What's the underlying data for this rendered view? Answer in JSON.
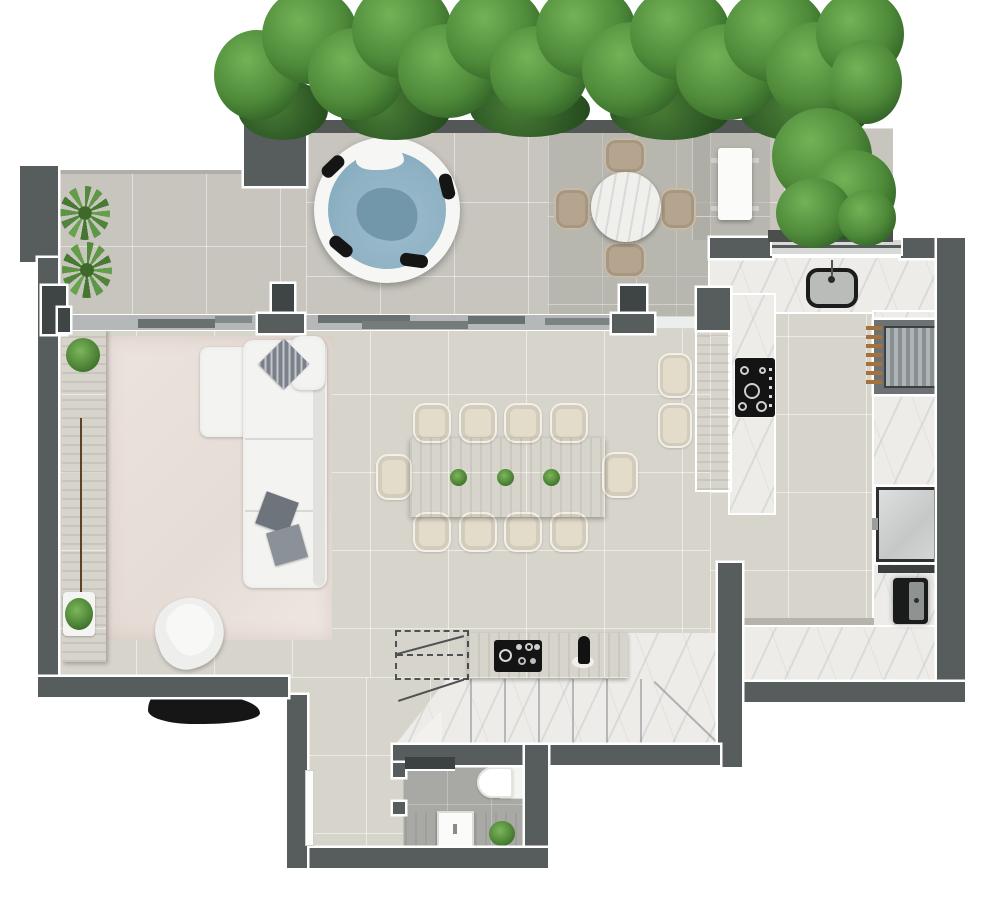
{
  "meta": {
    "title": "Penthouse floor plan - top-down 3D render",
    "view": "top-down architectural rendering",
    "visible_text": "none"
  },
  "rooms": [
    {
      "name": "terrace",
      "features": [
        "hedge-planter",
        "hot-tub",
        "fern-plants"
      ]
    },
    {
      "name": "outdoor-dining",
      "features": [
        "round-marble-table",
        "four-chairs",
        "white-bench"
      ]
    },
    {
      "name": "living-room",
      "features": [
        "wood-sideboard",
        "area-rug",
        "l-shaped-sofa",
        "swivel-armchair",
        "throw-pillows",
        "potted-plants"
      ]
    },
    {
      "name": "dining-area",
      "features": [
        "wood-table",
        "ten-chairs",
        "three-centerpiece-plants"
      ]
    },
    {
      "name": "kitchen",
      "features": [
        "u-shaped-marble-counter",
        "sink",
        "cooktop",
        "grill",
        "refrigerator",
        "wine-cooler",
        "wood-island",
        "two-bar-stools",
        "window"
      ]
    },
    {
      "name": "stair-hall",
      "features": [
        "wood-bar-counter",
        "espresso-machine",
        "bottle",
        "marble-winder-stairs",
        "dashed-stair-outline"
      ]
    },
    {
      "name": "bathroom",
      "features": [
        "toilet",
        "wood-vanity",
        "square-sink",
        "plant",
        "dark-shelf",
        "door-leaf"
      ]
    }
  ],
  "colors": {
    "background": "#ffffff",
    "wall": "#575c5c",
    "wall_dark": "#3f4444",
    "wall_outline": "#ffffff",
    "terrace_floor": "#c7c5be",
    "interior_floor": "#d6d4cb",
    "bath_floor": "#a8a8a4",
    "marble": "#edece8",
    "wood": "#a07148",
    "rug": "#eae1dc",
    "sofa": "#f3f3f1",
    "chair_cream": "#e4dccb",
    "outdoor_chair_tan": "#b5a48e",
    "hedge_green": "#4e8a39",
    "hot_tub_water": "#8fb2c4",
    "appliance_black": "#161818",
    "fridge_gray": "#d3d5d4"
  }
}
